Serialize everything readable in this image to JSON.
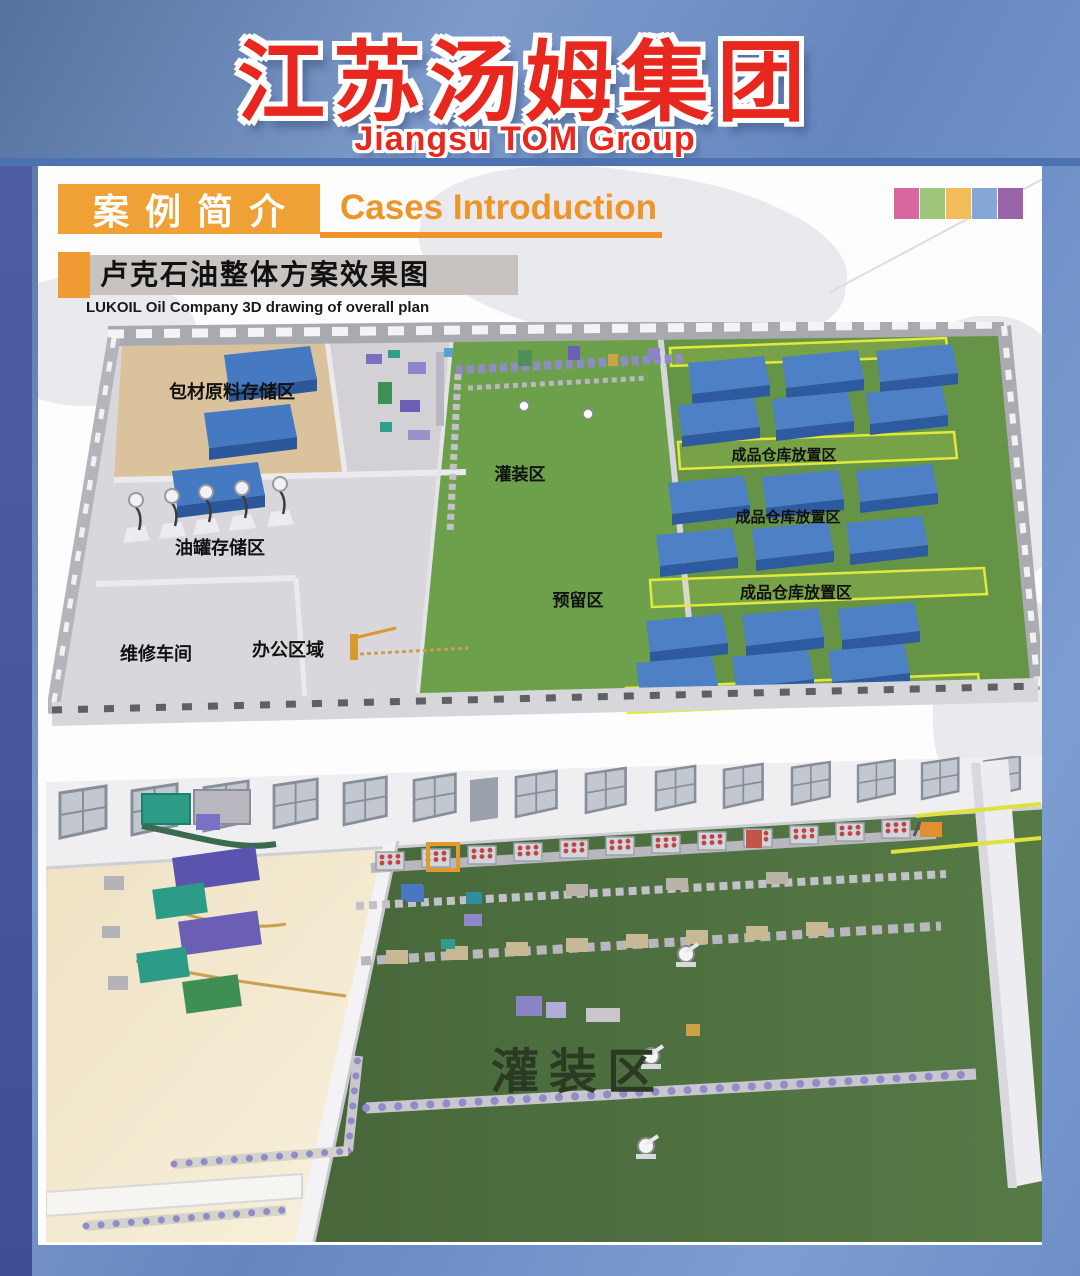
{
  "header": {
    "title_zh": "江苏汤姆集团",
    "title_en": "Jiangsu TOM Group"
  },
  "cases_banner": {
    "zh": "案例简介",
    "en": "Cases Introduction"
  },
  "case": {
    "title_zh": "卢克石油整体方案效果图",
    "title_en": "LUKOIL Oil Company 3D drawing of overall plan"
  },
  "palette": {
    "swatches": [
      "#d9679f",
      "#9ec578",
      "#f3bc5a",
      "#85a7d8",
      "#9a64a8"
    ]
  },
  "overall_plan": {
    "zones": {
      "packaging_storage": "包材原料存储区",
      "oil_tank_storage": "油罐存储区",
      "maintenance_workshop": "维修车间",
      "office_area": "办公区域",
      "filling_area": "灌装区",
      "reserved_area": "预留区",
      "finished_goods_1": "成品仓库放置区",
      "finished_goods_2": "成品仓库放置区",
      "finished_goods_3": "成品仓库放置区"
    }
  },
  "detail_plan": {
    "filling_area": "灌装区"
  },
  "colors": {
    "title_red": "#e8281e",
    "accent_orange": "#ef9a33",
    "divider_blue": "#4c72b0",
    "plan_green": "#6ca04b",
    "warehouse_green": "#659447",
    "detail_green": "#4e7040",
    "storage_block_blue": "#4d80c5",
    "zone_strip_yellow": "#e2e93e"
  }
}
